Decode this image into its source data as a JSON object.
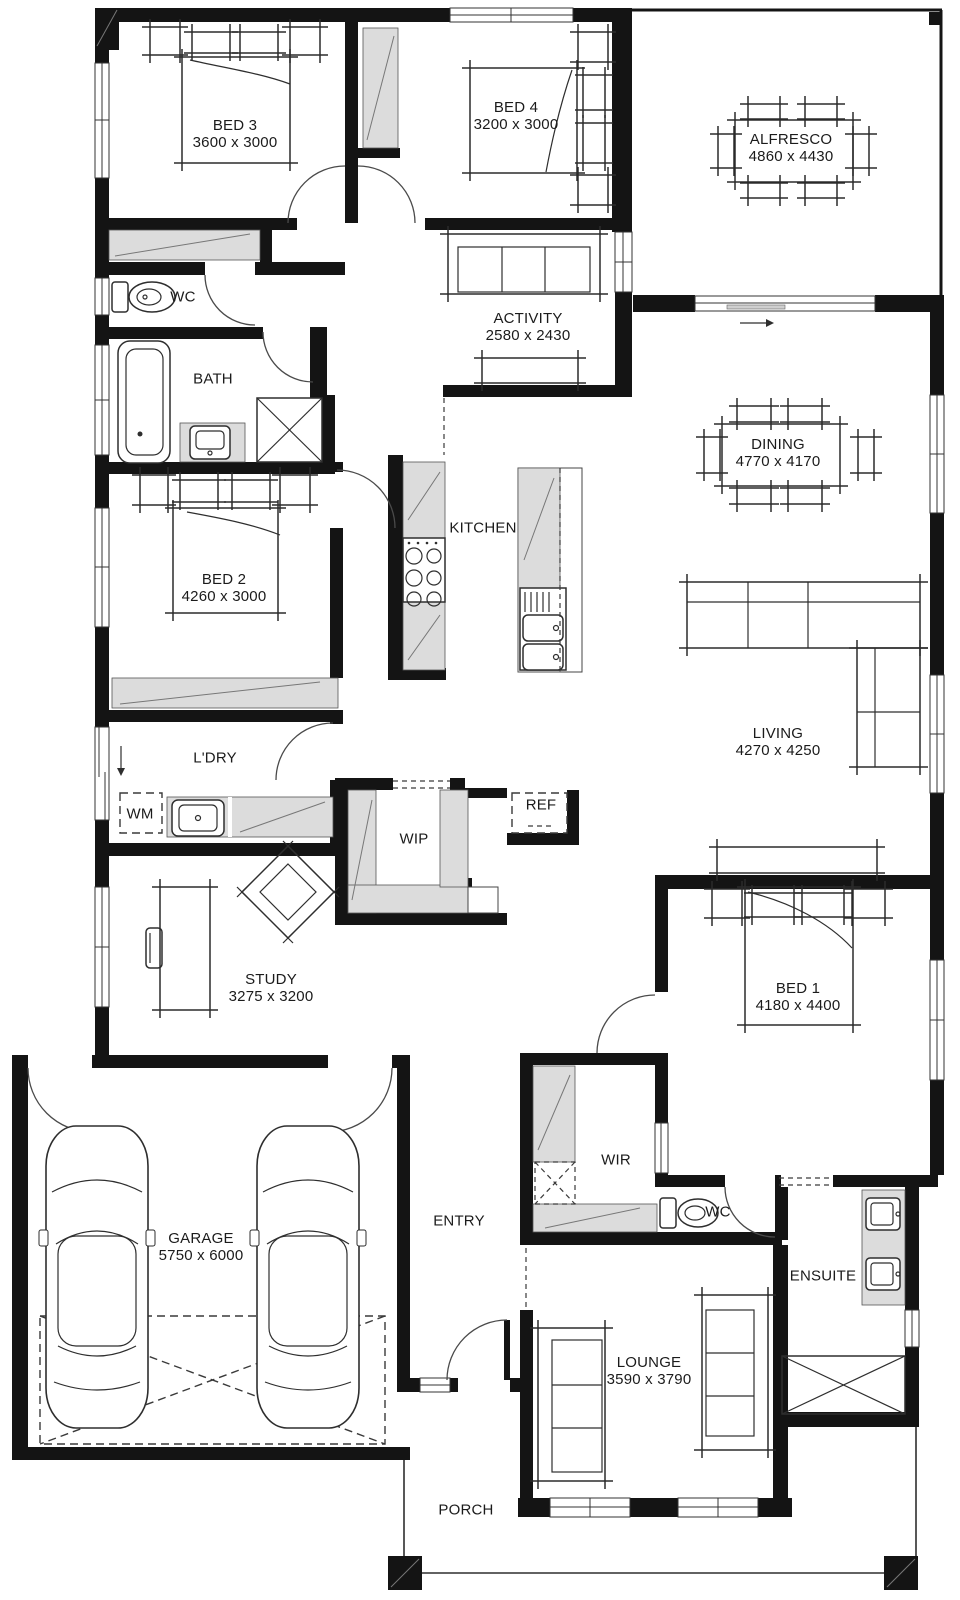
{
  "title": "House floor plan",
  "colors": {
    "wall": "#141414",
    "cabinet": "#dcdcdc",
    "line": "#2e2e2e",
    "background": "#ffffff"
  },
  "rooms": [
    {
      "id": "bed3",
      "name": "BED 3",
      "dims": "3600 x 3000"
    },
    {
      "id": "bed4",
      "name": "BED 4",
      "dims": "3200 x 3000"
    },
    {
      "id": "alfresco",
      "name": "ALFRESCO",
      "dims": "4860 x 4430"
    },
    {
      "id": "wc",
      "name": "WC"
    },
    {
      "id": "activity",
      "name": "ACTIVITY",
      "dims": "2580 x 2430"
    },
    {
      "id": "bath",
      "name": "BATH"
    },
    {
      "id": "dining",
      "name": "DINING",
      "dims": "4770 x 4170"
    },
    {
      "id": "bed2",
      "name": "BED 2",
      "dims": "4260 x 3000"
    },
    {
      "id": "kitchen",
      "name": "KITCHEN"
    },
    {
      "id": "living",
      "name": "LIVING",
      "dims": "4270 x 4250"
    },
    {
      "id": "ldry",
      "name": "L'DRY"
    },
    {
      "id": "wm",
      "name": "WM"
    },
    {
      "id": "wip",
      "name": "WIP"
    },
    {
      "id": "ref",
      "name": "REF"
    },
    {
      "id": "study",
      "name": "STUDY",
      "dims": "3275 x 3200"
    },
    {
      "id": "bed1",
      "name": "BED 1",
      "dims": "4180 x 4400"
    },
    {
      "id": "garage",
      "name": "GARAGE",
      "dims": "5750 x 6000"
    },
    {
      "id": "entry",
      "name": "ENTRY"
    },
    {
      "id": "wir",
      "name": "WIR"
    },
    {
      "id": "wc2",
      "name": "WC"
    },
    {
      "id": "ensuite",
      "name": "ENSUITE"
    },
    {
      "id": "lounge",
      "name": "LOUNGE",
      "dims": "3590 x 3790"
    },
    {
      "id": "porch",
      "name": "PORCH"
    }
  ]
}
